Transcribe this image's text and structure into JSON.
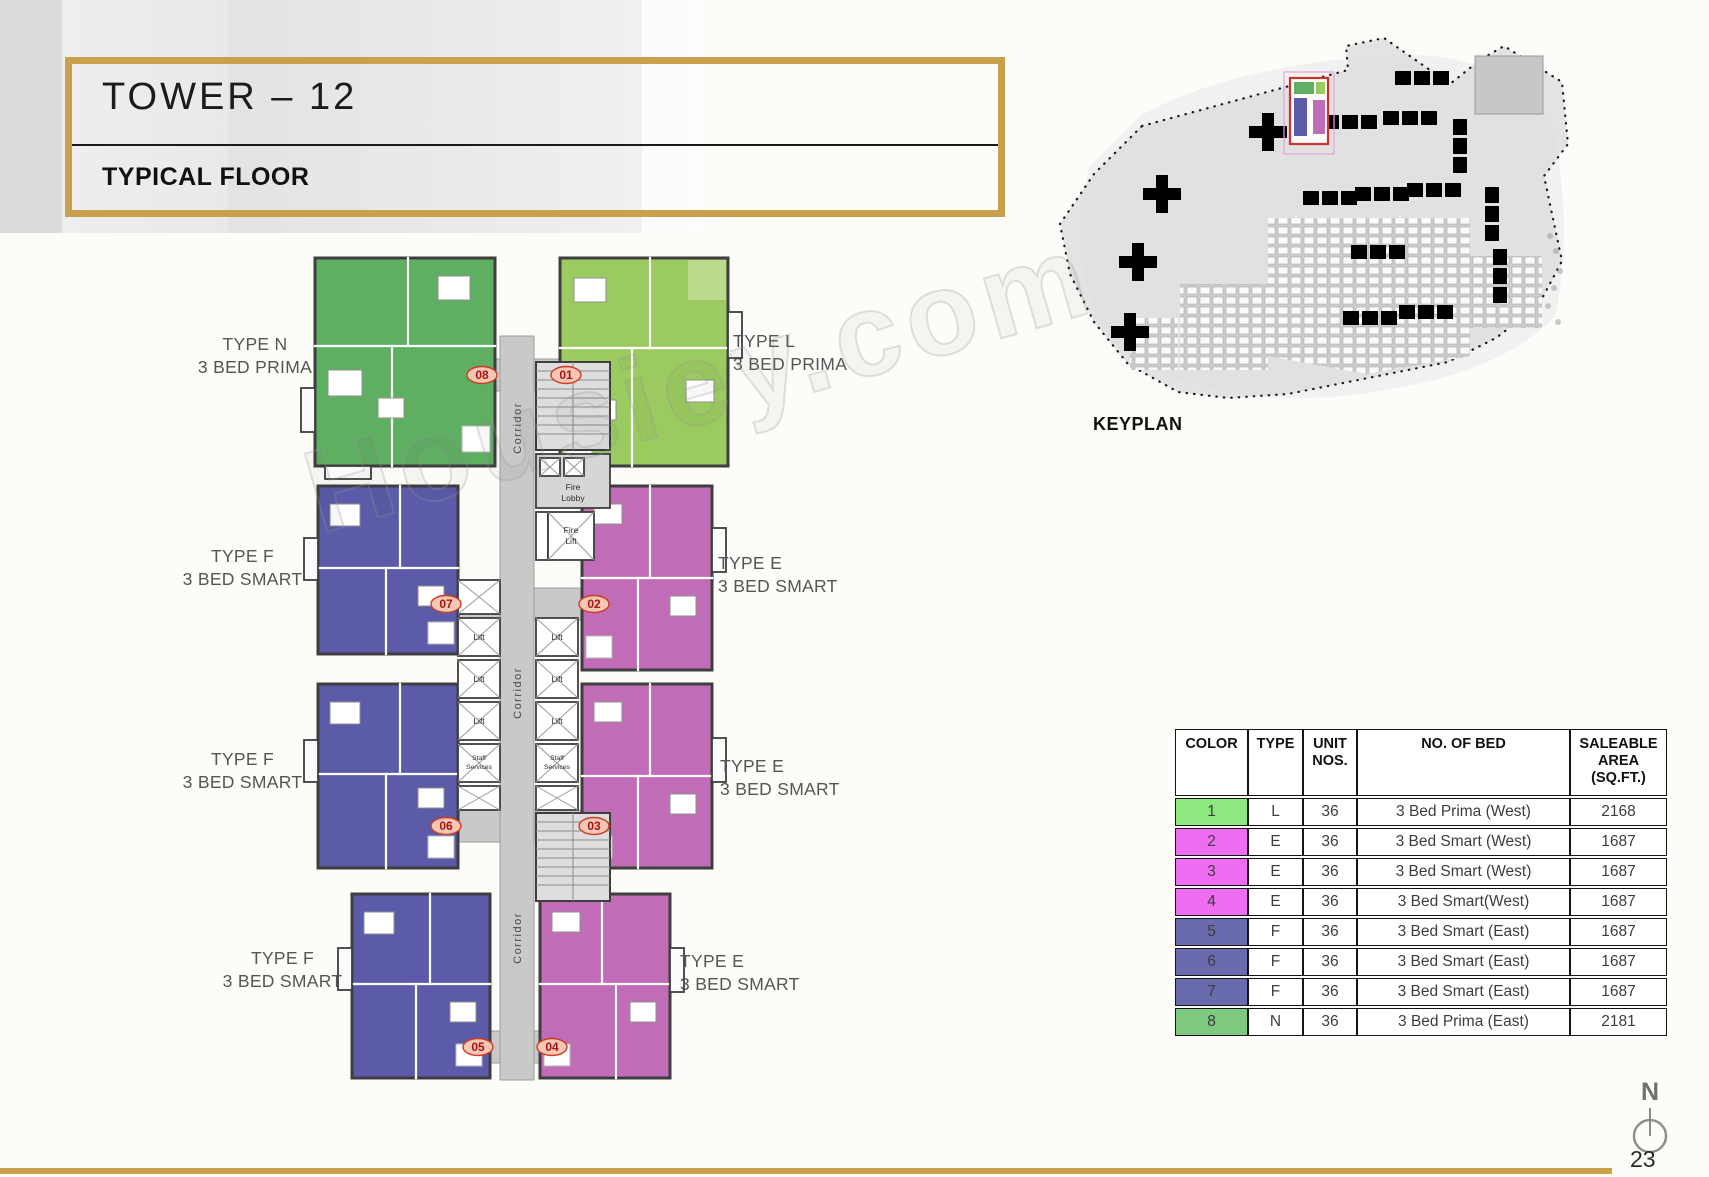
{
  "page": {
    "number": "23"
  },
  "colors": {
    "gold": "#C9A04B",
    "wall": "#3E3E3E",
    "corridor_gray": "#C9C9C9",
    "keyplan_highlight": "#C83333"
  },
  "header": {
    "title": "TOWER – 12",
    "subtitle": "TYPICAL FLOOR"
  },
  "keyplan": {
    "label": "KEYPLAN"
  },
  "watermark": "Housiey.com",
  "floorplan": {
    "corridor": "Corridor",
    "lift": "Lift",
    "fire_lobby": [
      "Fire",
      "Lobby"
    ],
    "fire_lift": [
      "Fire",
      "Lift"
    ],
    "staff_services": [
      "Staff",
      "Services"
    ],
    "unit_numbers": [
      "08",
      "01",
      "07",
      "02",
      "06",
      "03",
      "05",
      "04"
    ],
    "labels": [
      {
        "type": "TYPE N",
        "bed": "3 BED PRIMA"
      },
      {
        "type": "TYPE L",
        "bed": "3 BED PRIMA"
      },
      {
        "type": "TYPE F",
        "bed": "3 BED SMART"
      },
      {
        "type": "TYPE E",
        "bed": "3 BED SMART"
      },
      {
        "type": "TYPE F",
        "bed": "3 BED SMART"
      },
      {
        "type": "TYPE E",
        "bed": "3 BED SMART"
      },
      {
        "type": "TYPE F",
        "bed": "3 BED SMART"
      },
      {
        "type": "TYPE E",
        "bed": "3 BED SMART"
      }
    ],
    "colors": {
      "type_n": "#5FAF63",
      "type_l": "#9BCB60",
      "type_l_light": "#BCDA8E",
      "type_f": "#5B5BA9",
      "type_e": "#C06CB6"
    }
  },
  "compass": {
    "north": "N"
  },
  "table": {
    "headers": [
      "COLOR",
      "TYPE",
      "UNIT\nNOS.",
      "NO. OF BED",
      "SALEABLE\nAREA\n(SQ.FT.)"
    ],
    "rows": [
      {
        "color_no": "1",
        "color": "#8DE97F",
        "type": "L",
        "unit_nos": "36",
        "no_of_bed": "3 Bed Prima (West)",
        "area": "2168"
      },
      {
        "color_no": "2",
        "color": "#F06CF0",
        "type": "E",
        "unit_nos": "36",
        "no_of_bed": "3 Bed Smart (West)",
        "area": "1687"
      },
      {
        "color_no": "3",
        "color": "#F06CF0",
        "type": "E",
        "unit_nos": "36",
        "no_of_bed": "3 Bed Smart (West)",
        "area": "1687"
      },
      {
        "color_no": "4",
        "color": "#F06CF0",
        "type": "E",
        "unit_nos": "36",
        "no_of_bed": "3 Bed Smart(West)",
        "area": "1687"
      },
      {
        "color_no": "5",
        "color": "#6A6AAE",
        "type": "F",
        "unit_nos": "36",
        "no_of_bed": "3 Bed Smart (East)",
        "area": "1687"
      },
      {
        "color_no": "6",
        "color": "#6A6AAE",
        "type": "F",
        "unit_nos": "36",
        "no_of_bed": "3 Bed Smart (East)",
        "area": "1687"
      },
      {
        "color_no": "7",
        "color": "#6A6AAE",
        "type": "F",
        "unit_nos": "36",
        "no_of_bed": "3 Bed Smart (East)",
        "area": "1687"
      },
      {
        "color_no": "8",
        "color": "#7CC97F",
        "type": "N",
        "unit_nos": "36",
        "no_of_bed": "3 Bed Prima (East)",
        "area": "2181"
      }
    ]
  }
}
